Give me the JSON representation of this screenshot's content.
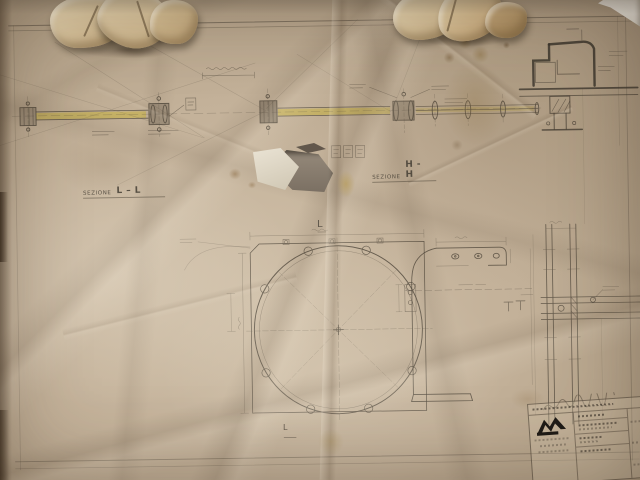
{
  "scene": {
    "description": "Photograph of an old creased and torn engineering drawing (Italian) taped to a wall, with crumpled paper scraps along the top edge and a stamped title block at bottom right"
  },
  "labels": {
    "section_ll": {
      "prefix": "SEZIONE",
      "id": "L–L"
    },
    "section_hh": {
      "prefix": "SEZIONE",
      "id": "H-H"
    },
    "marker_center": "L",
    "marker_bottom": "L"
  },
  "title_block": {
    "logo_icon": "zigzag-monogram-logo",
    "note": "handwritten-annotation-illegible",
    "rows": "typed-text-illegible"
  },
  "drawing_features": [
    "long horizontal tie-rod with bolted coupling joints, highlighted yellow",
    "stepped wall anchorage detail, top right",
    "large circular flange plate with bolt circle",
    "curved bracket side view with drilled top flange",
    "column section with crossing beam, bottom right"
  ],
  "colors": {
    "paper": "#c3b199",
    "paper_light": "#d6c7b1",
    "paper_dark": "#a3917a",
    "wall_white": "#e9e5de",
    "pencil": "#4e463a",
    "ink_dark": "#37322a",
    "highlight_yellow": "#c8b245",
    "stain_brown": "#8a6a42",
    "stain_yellow": "#b89a4c"
  }
}
